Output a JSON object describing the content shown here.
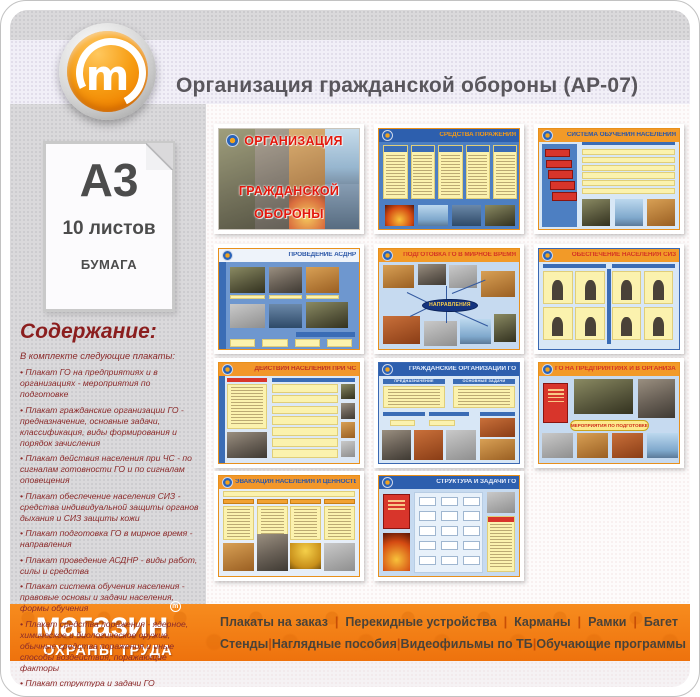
{
  "header": {
    "title": "Организация гражданской обороны (АР-07)",
    "logo_letter": "m"
  },
  "sidebar": {
    "format_label": "А3",
    "sheets_label": "10 листов",
    "material_label": "БУМАГА",
    "contents_heading": "Содержание:",
    "contents_intro": "В комплекте следующие плакаты:",
    "contents_items": [
      "Плакат ГО на предприятиях и в организациях - мероприятия по подготовке",
      "Плакат гражданские организации ГО - предназначение, основные задачи, классификация, виды формирования и порядок зачисления",
      "Плакат действия населения при ЧС - по сигналам готовности ГО и по сигналам оповещения",
      "Плакат обеспечение населения СИЗ - средства индивидуальной защиты органов дыхания и СИЗ защиты кожи",
      "Плакат подготовка ГО в мирное время - направления",
      "Плакат проведение АСДНР - виды работ, силы и средства",
      "Плакат система обучения населения - правовые основы и задачи населения, формы обучения",
      "Плакат средства поражения - ядерное, химическое и биологическое оружие, обычные средства поражения и иные способы воздействия, поражающие факторы",
      "Плакат структура и задачи ГО",
      "Плакат эвакуация населения и ценностей - варианты и способы эвакуации, эвакуация культурных и материальных ценностей"
    ]
  },
  "posters": [
    {
      "variant": "cover",
      "title_lines": [
        "ОРГАНИЗАЦИЯ",
        "ГРАЖДАНСКОЙ",
        "ОБОРОНЫ"
      ],
      "hb": "",
      "hc": "#e3170c",
      "bb": "#d8d4cc",
      "fb": "#c9c4ba"
    },
    {
      "variant": "columns",
      "title": "СРЕДСТВА ПОРАЖЕНИЯ",
      "hb": "#2d5fae",
      "hc": "#f29a1a",
      "bb": "#4d7fc2",
      "fb": "#e8901c"
    },
    {
      "variant": "cascade",
      "title": "СИСТЕМА ОБУЧЕНИЯ НАСЕЛЕНИЯ",
      "hb": "#f29a28",
      "hc": "#2d58a8",
      "bb": "#d8e7f6",
      "fb": "#e8901c"
    },
    {
      "variant": "photogrid",
      "title": "ПРОВЕДЕНИЕ АСДНР",
      "hb": "#eef3fa",
      "hc": "#2d58a8",
      "bb": "#6e97cf",
      "fb": "#e8901c"
    },
    {
      "variant": "radial",
      "title": "ПОДГОТОВКА ГО В МИРНОЕ ВРЕМЯ",
      "hb": "#f29a28",
      "hc": "#d53624",
      "bb": "#c6daf0",
      "fb": "#e8901c",
      "center_label": "НАПРАВЛЕНИЯ"
    },
    {
      "variant": "siz",
      "title": "ОБЕСПЕЧЕНИЕ НАСЕЛЕНИЯ СИЗ",
      "hb": "#f29a28",
      "hc": "#d53624",
      "bb": "#d8e7f6",
      "fb": "#3a68b2"
    },
    {
      "variant": "twocol",
      "title": "ДЕЙСТВИЯ НАСЕЛЕНИЯ ПРИ ЧС",
      "hb": "#f2972a",
      "hc": "#c03224",
      "bb": "#dce8f6",
      "fb": "#e8901c"
    },
    {
      "variant": "org",
      "title": "ГРАЖДАНСКИЕ ОРГАНИЗАЦИИ ГО",
      "hb": "#2d5fae",
      "hc": "#dfe9fa",
      "bb": "#d8e7f6",
      "fb": "#3a68b2",
      "sub_labels": [
        "ПРЕДНАЗНАЧЕНИЕ",
        "ОСНОВНЫЕ ЗАДАЧИ"
      ]
    },
    {
      "variant": "enterprise",
      "title": "ГО НА ПРЕДПРИЯТИЯХ И В ОРГАНИЗАЦИЯХ",
      "hb": "#f29a28",
      "hc": "#d53624",
      "bb": "#c6daf0",
      "fb": "#e8901c",
      "center_label": "МЕРОПРИЯТИЯ ПО ПОДГОТОВКЕ"
    },
    {
      "variant": "evac",
      "title": "ЭВАКУАЦИЯ НАСЕЛЕНИЯ И ЦЕННОСТЕЙ",
      "hb": "#f2972a",
      "hc": "#2d58a8",
      "bb": "#e6eef8",
      "fb": "#e8901c"
    },
    {
      "variant": "structure",
      "title": "СТРУКТУРА И ЗАДАЧИ ГО",
      "hb": "#2d5fae",
      "hc": "#e8eefc",
      "bb": "#c6daf0",
      "fb": "#e8901c"
    }
  ],
  "footer": {
    "brand_line1": "магазин",
    "tm_letter": "m",
    "brand_line2": "ОХРАНЫ ТРУДА",
    "separator": "|",
    "menu_row1": [
      "Плакаты на заказ",
      "Перекидные устройства",
      "Карманы",
      "Рамки",
      "Багет"
    ],
    "menu_row2": [
      "Стенды",
      "Наглядные пособия",
      "Видеофильмы по ТБ",
      "Обучающие программы"
    ]
  },
  "colors": {
    "footer_orange": "#ee720d",
    "accent_red": "#8b1e1e",
    "band_lavender": "#f1eff7",
    "panel_gray": "#dad9db",
    "poster_blue": "#2d5fae",
    "poster_orange_header": "#f29a28",
    "poster_yellow": "#fbf2ae"
  }
}
